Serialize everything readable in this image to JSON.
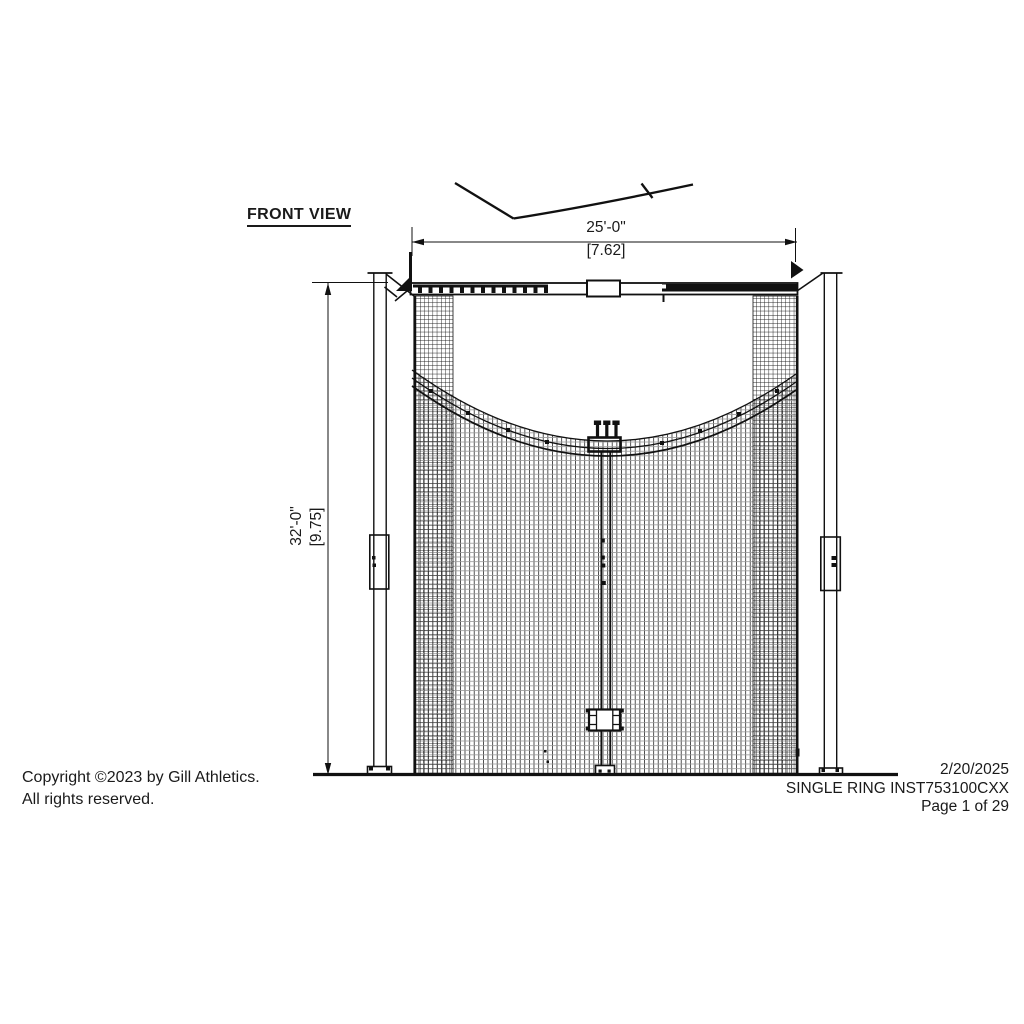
{
  "title": "FRONT VIEW",
  "dimensions": {
    "width_imperial": "25'-0\"",
    "width_metric": "[7.62]",
    "height_imperial": "32'-0\"",
    "height_metric": "[9.75]"
  },
  "footer": {
    "copyright_line1": "Copyright ©2023 by Gill Athletics.",
    "copyright_line2": "All rights reserved.",
    "date": "2/20/2025",
    "document": "SINGLE RING INST753100CXX",
    "page": "Page 1 of 29"
  },
  "colors": {
    "line": "#1a1a1a",
    "background": "#ffffff"
  }
}
